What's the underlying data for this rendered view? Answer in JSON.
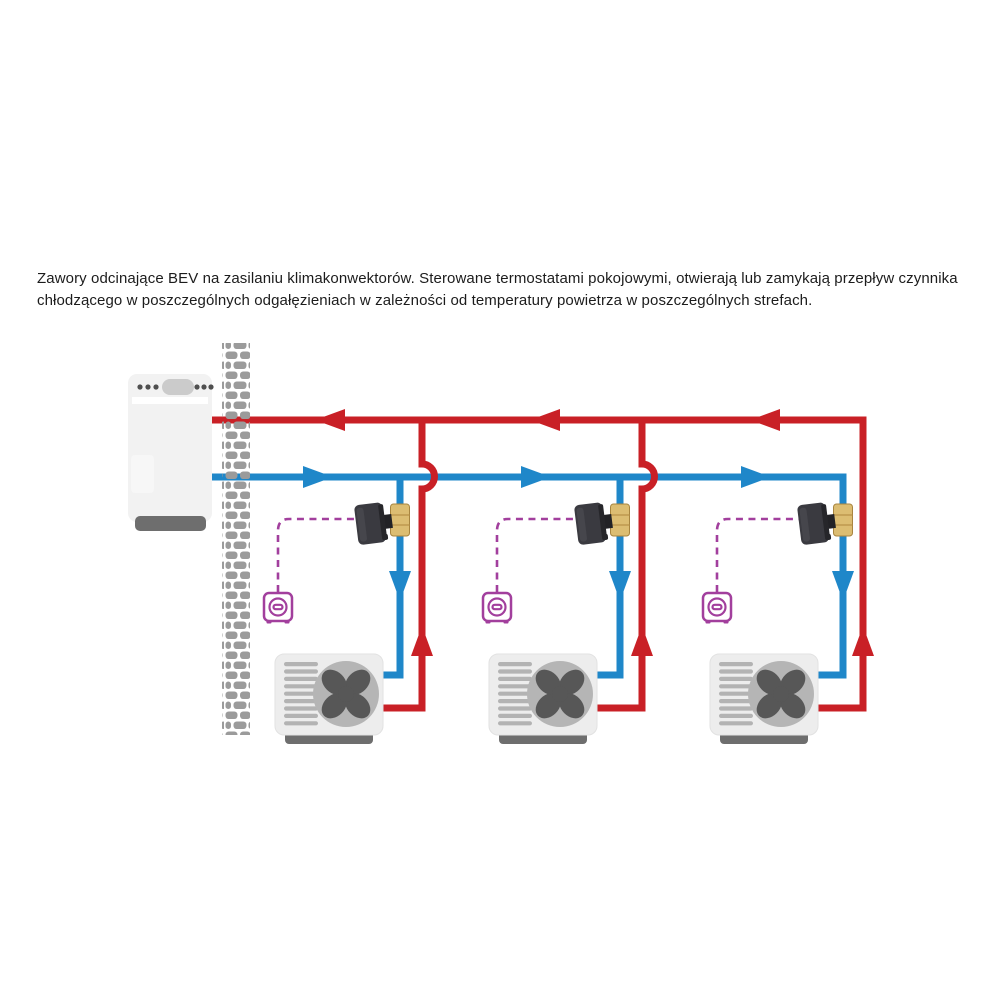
{
  "caption": {
    "text": "Zawory odcinające BEV na zasilaniu klimakonwektorów. Sterowane termostatami pokojowymi, otwierają lub zamykają przepływ czynnika chłodzącego w poszczególnych odgałęzieniach w zależności od temperatury powietrza w poszczególnych strefach."
  },
  "colors": {
    "return-red": "#c92026",
    "supply-blue": "#1f87c9",
    "control-purple": "#a23f9d",
    "wall-gray": "#9b9b9b",
    "pump-body": "#f2f2f2",
    "unit-body": "#ededed",
    "fan-disc": "#b5b5b5",
    "fan-blade": "#575757",
    "base-gray": "#6e6e6e",
    "brass": "#dcbd72",
    "actuator": "#3a3a40",
    "text": "#1c1c1c"
  },
  "components": {
    "heat_pump": "heat-pump-outdoor-unit",
    "wall": "brick-wall",
    "pipes": {
      "supply": "chilled-water-supply-blue",
      "return": "chilled-water-return-red"
    },
    "branches": [
      {
        "valve": "bev-shutoff-valve",
        "thermostat": "room-thermostat",
        "fan_coil": "fan-coil-unit"
      },
      {
        "valve": "bev-shutoff-valve",
        "thermostat": "room-thermostat",
        "fan_coil": "fan-coil-unit"
      },
      {
        "valve": "bev-shutoff-valve",
        "thermostat": "room-thermostat",
        "fan_coil": "fan-coil-unit"
      }
    ]
  }
}
